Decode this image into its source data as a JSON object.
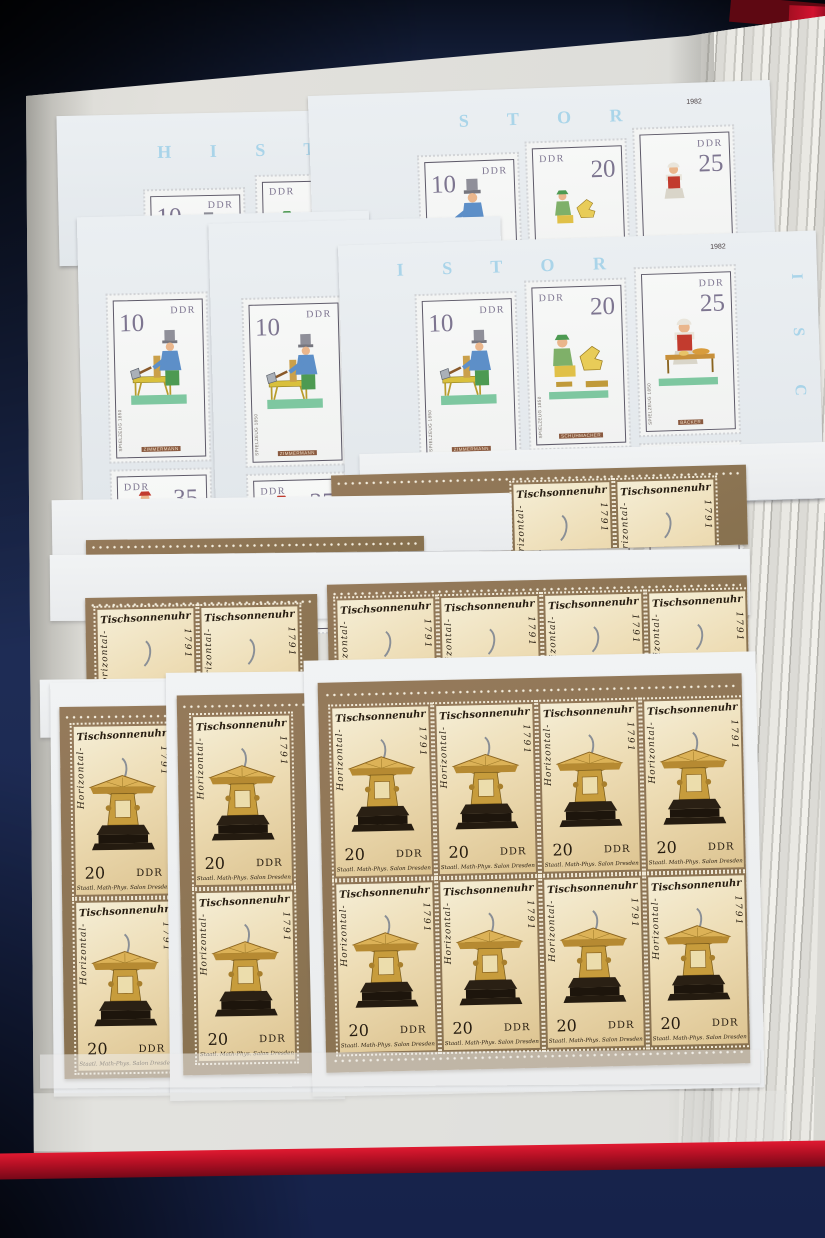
{
  "scene_colors": {
    "table_navy": "#1d2b52",
    "album_cover_red": "#b5122a",
    "page_cream": "#dededa",
    "sheet_brown": "#8d7352",
    "stamp_cream": "#eddcb4",
    "margin_letter_blue": "#9fd0e8"
  },
  "spielzeug_series": {
    "country": "DDR",
    "sheet_year": "1982",
    "margin_letters": {
      "s1_top": "H I S T",
      "s2_top": "S T O R",
      "s3_top": "H I",
      "s3_left": "E F U",
      "s3b_left": "U R",
      "s4_top": "I S T O R",
      "s4_right": "I S C E"
    },
    "stamps": {
      "v10": {
        "value": "10",
        "caption": "ZIMMERMANN",
        "side": "SPIELZEUG 1850"
      },
      "v20": {
        "value": "20",
        "caption": "SCHUHMACHER",
        "side": "SPIELZEUG 1850"
      },
      "v25": {
        "value": "25",
        "caption": "BÄCKER",
        "side": "SPIELZEUG 1850"
      },
      "v35": {
        "value": "35"
      },
      "v40": {
        "value": "40"
      },
      "v70": {
        "value": "70"
      }
    }
  },
  "sundial_series": {
    "country": "DDR",
    "title": "Tischsonnenuhr",
    "type_left": "Horizontal-",
    "year_right": "1791",
    "value": "20",
    "caption": "Staatl. Math-Phys. Salon Dresden"
  }
}
